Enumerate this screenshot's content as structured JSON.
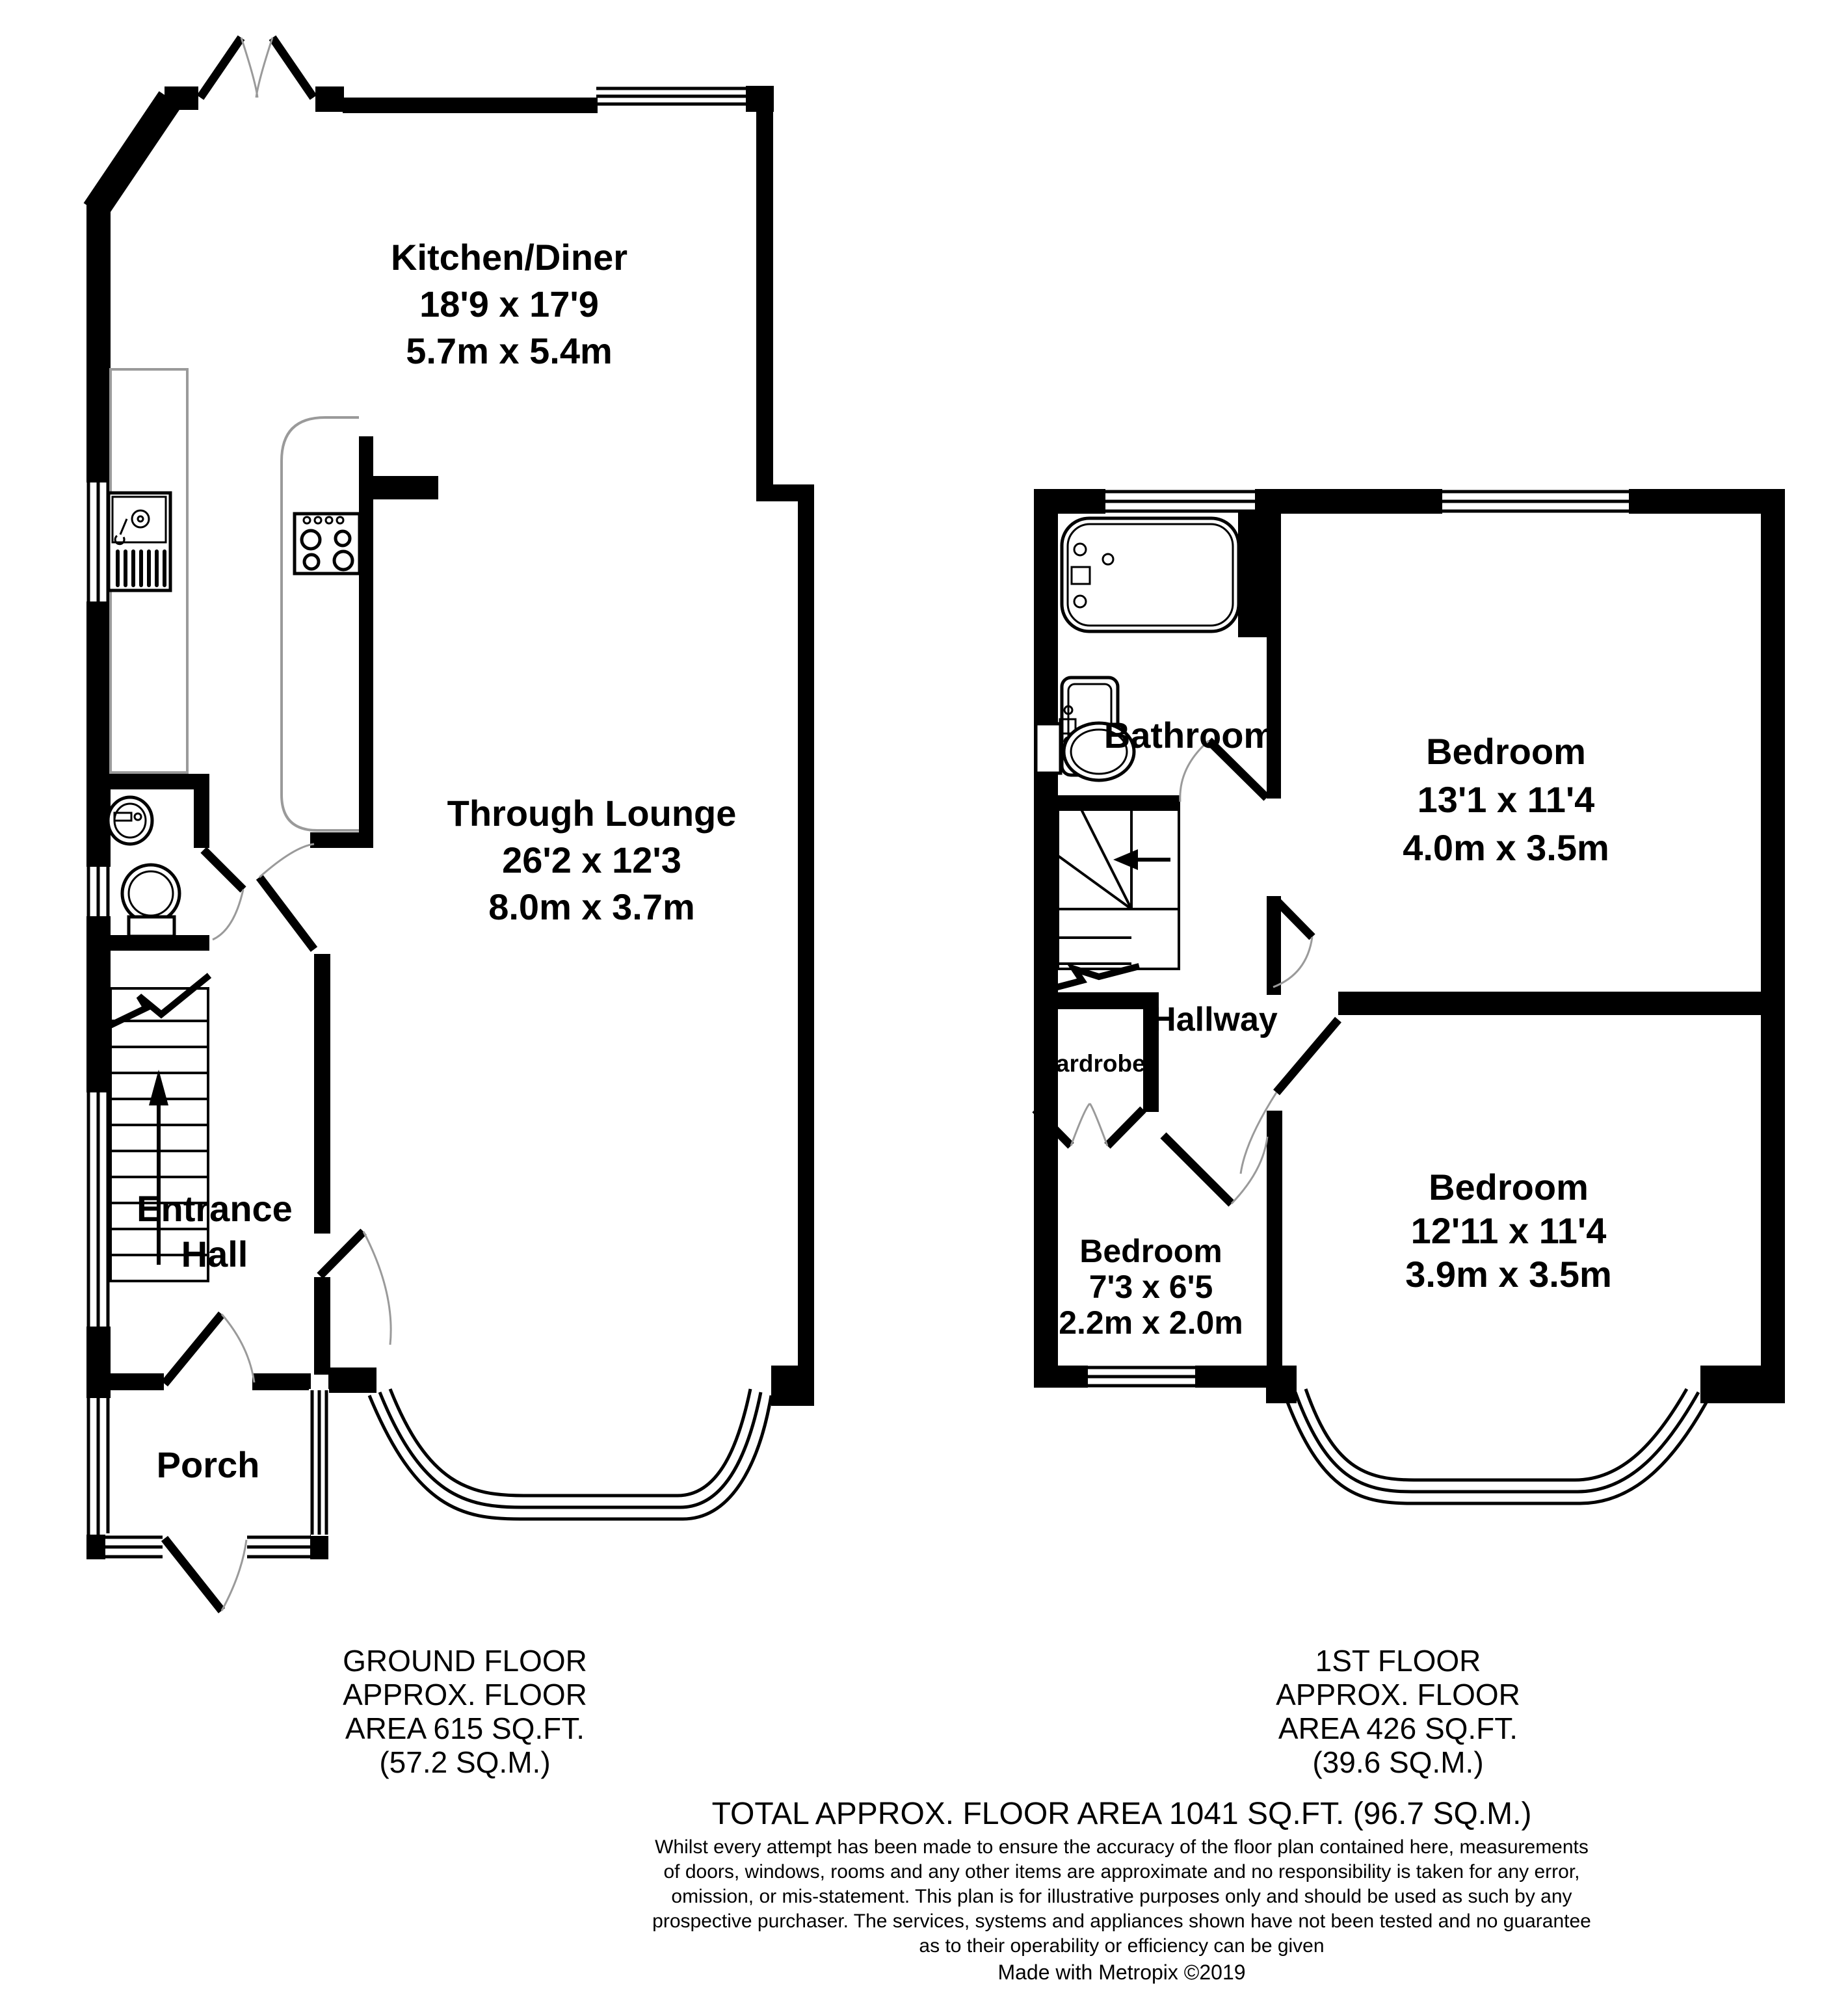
{
  "document": {
    "type": "floorplan",
    "style": "metropix"
  },
  "colors": {
    "wall": "#000000",
    "fixture_gray": "#9a9a9a",
    "background": "#ffffff"
  },
  "ground_floor": {
    "rooms": {
      "kitchen_diner": {
        "name": "Kitchen/Diner",
        "dims_imperial": "18'9 x 17'9",
        "dims_metric": "5.7m x 5.4m"
      },
      "through_lounge": {
        "name": "Through Lounge",
        "dims_imperial": "26'2 x 12'3",
        "dims_metric": "8.0m x 3.7m"
      },
      "entrance_hall": {
        "name_line1": "Entrance",
        "name_line2": "Hall"
      },
      "porch": {
        "name": "Porch"
      }
    },
    "summary": {
      "line1": "GROUND FLOOR",
      "line2": "APPROX. FLOOR",
      "line3": "AREA 615 SQ.FT.",
      "line4": "(57.2 SQ.M.)"
    }
  },
  "first_floor": {
    "rooms": {
      "bathroom": {
        "name": "Bathroom"
      },
      "bedroom1": {
        "name": "Bedroom",
        "dims_imperial": "13'1 x 11'4",
        "dims_metric": "4.0m x 3.5m"
      },
      "hallway": {
        "name": "Hallway"
      },
      "wardrobe": {
        "name": "Wardrobe"
      },
      "bedroom2": {
        "name": "Bedroom",
        "dims_imperial": "7'3 x 6'5",
        "dims_metric": "2.2m x 2.0m"
      },
      "bedroom3": {
        "name": "Bedroom",
        "dims_imperial": "12'11 x 11'4",
        "dims_metric": "3.9m x 3.5m"
      }
    },
    "summary": {
      "line1": "1ST FLOOR",
      "line2": "APPROX. FLOOR",
      "line3": "AREA 426 SQ.FT.",
      "line4": "(39.6 SQ.M.)"
    }
  },
  "footer": {
    "total": "TOTAL APPROX. FLOOR AREA 1041 SQ.FT. (96.7 SQ.M.)",
    "disclaimer_lines": [
      "Whilst every attempt has been made to ensure the accuracy of the floor plan contained here, measurements",
      "of doors, windows, rooms and any other items are approximate and no responsibility is taken for any error,",
      "omission, or mis-statement. This plan is for illustrative purposes only and should be used as such by any",
      "prospective purchaser. The services, systems and appliances shown have not been tested and no guarantee",
      "as to their operability or efficiency can be given"
    ],
    "credit": "Made with Metropix ©2019"
  }
}
